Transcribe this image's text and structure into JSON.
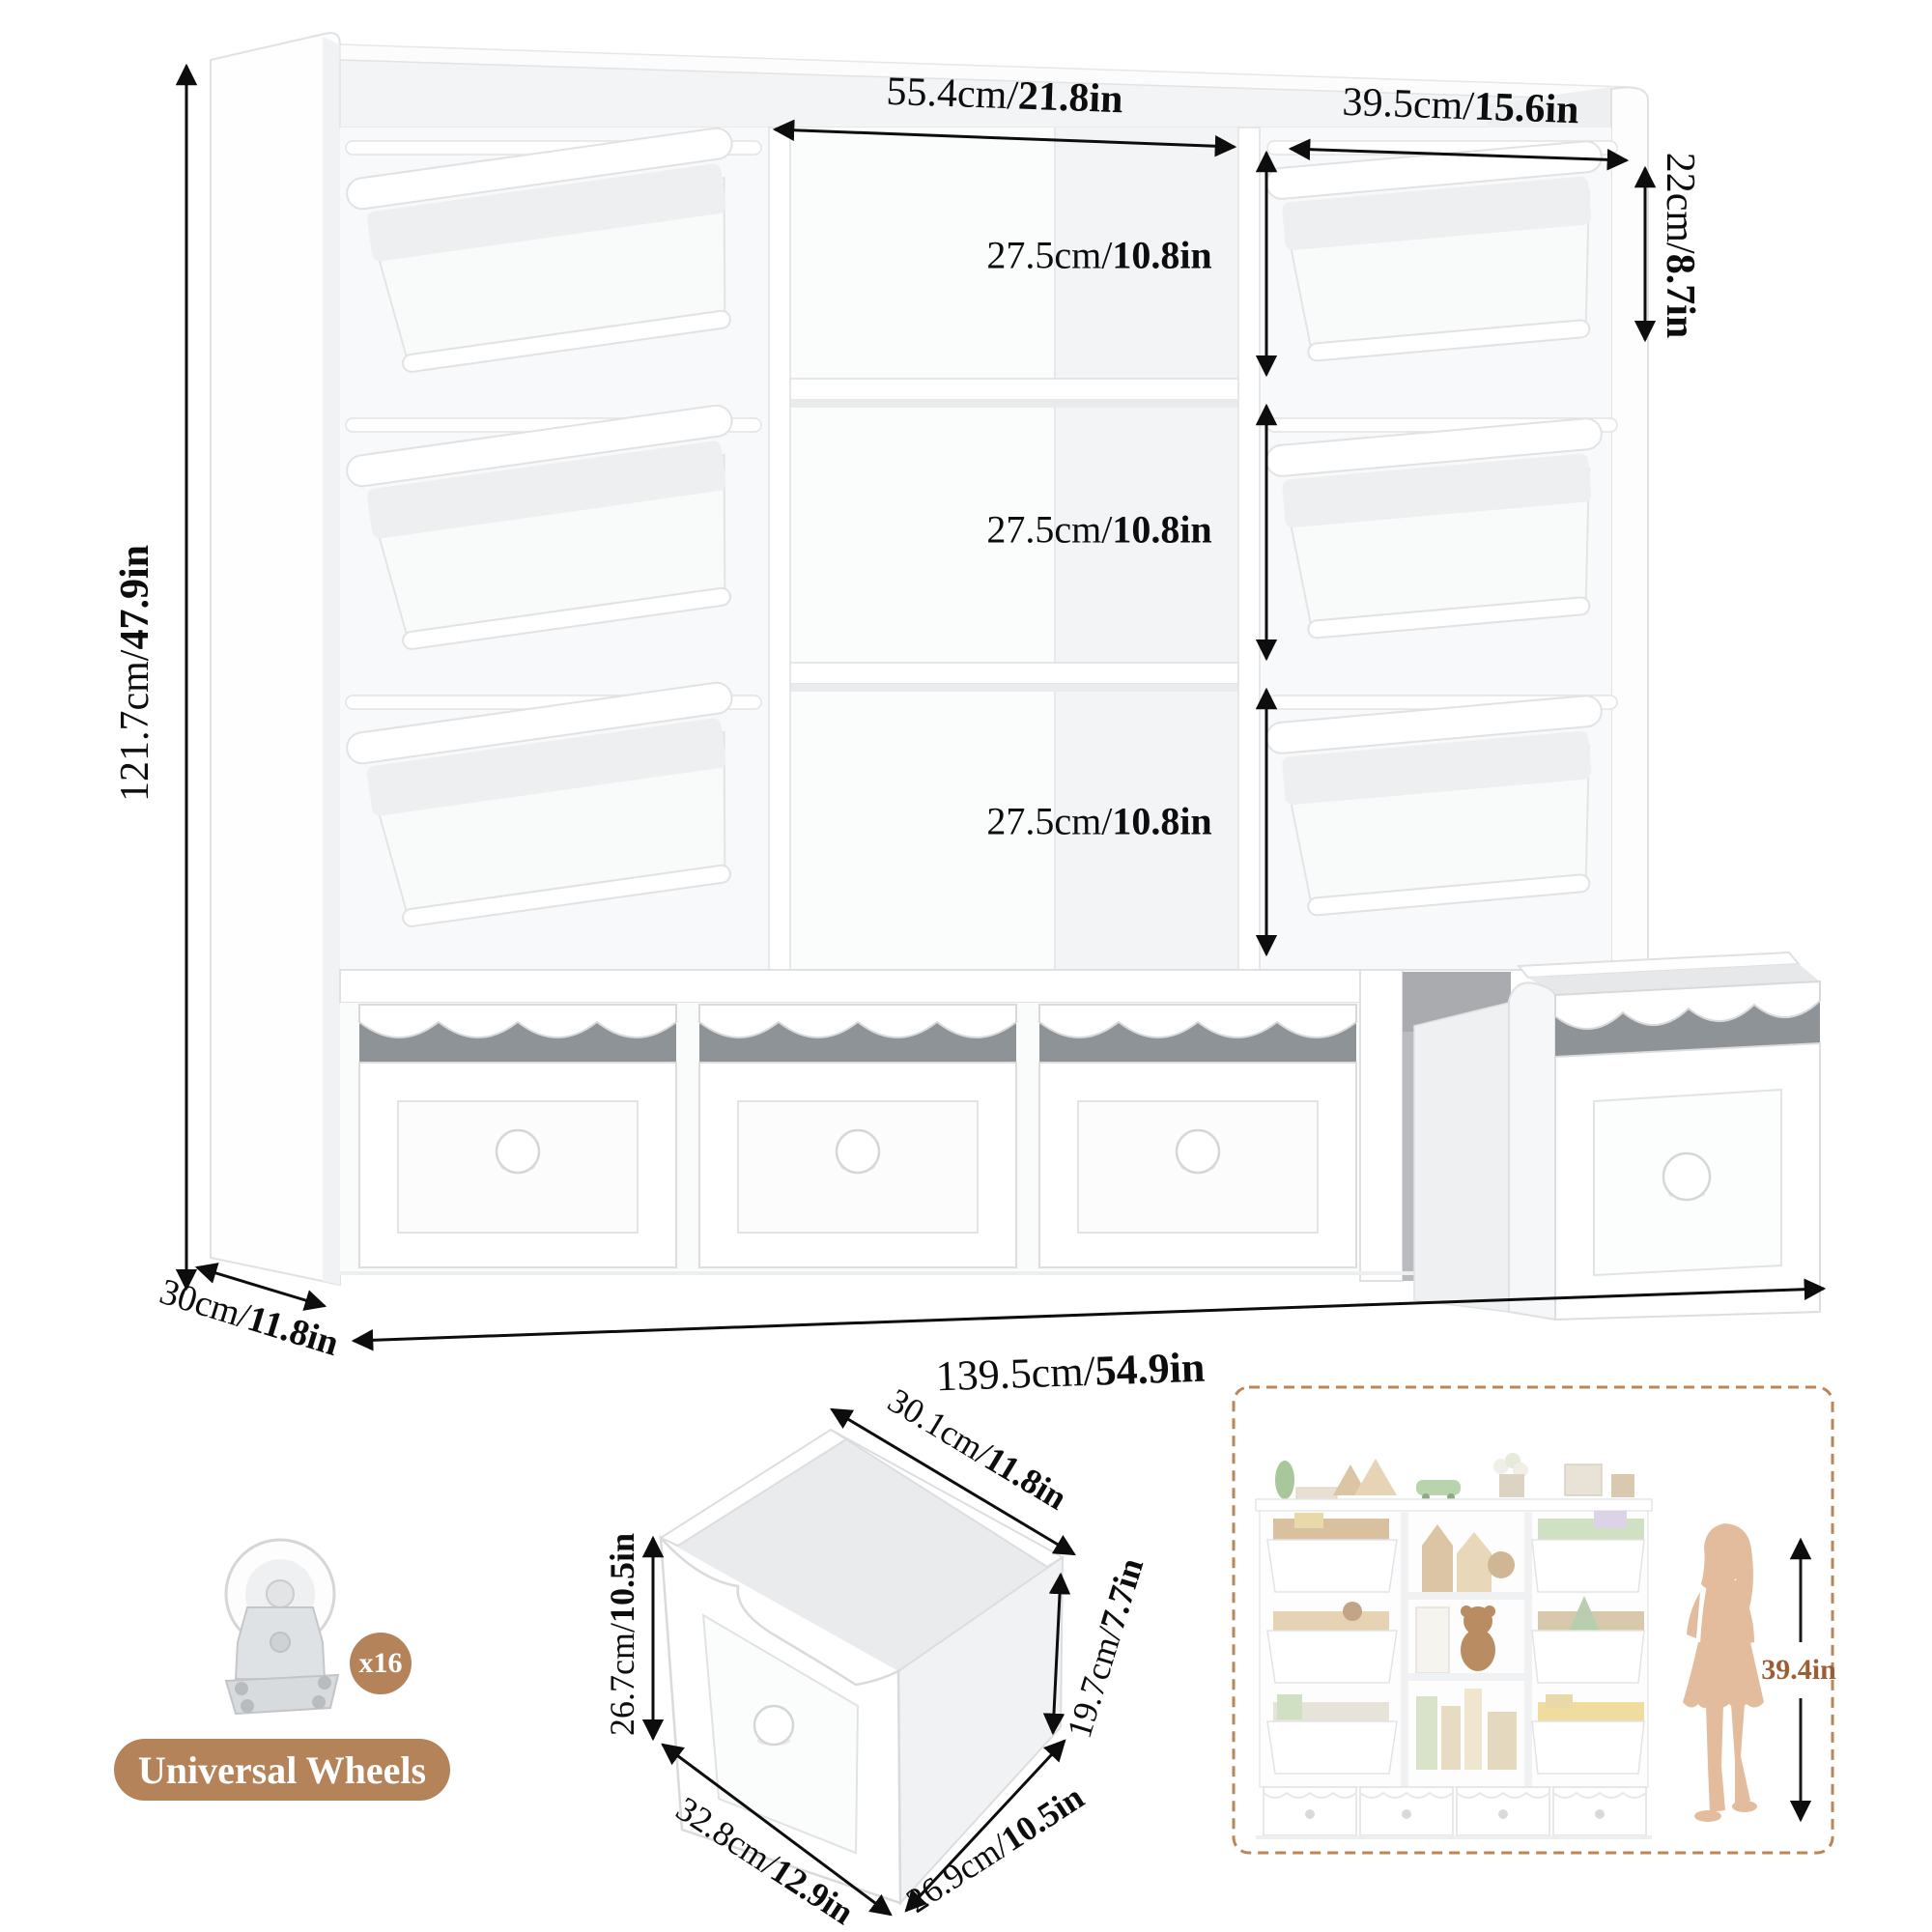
{
  "colors": {
    "accent_tan": "#b5835a",
    "brown_text": "#9c5f35",
    "silhouette": "#e2bc9c",
    "dashed_border": "#bc8556",
    "dim_text": "#0d0d0d"
  },
  "main_diagram": {
    "overall_height": {
      "metric": "121.7cm/",
      "imperial": "47.9in"
    },
    "top_middle_width": {
      "metric": "55.4cm/",
      "imperial": "21.8in"
    },
    "top_right_width": {
      "metric": "39.5cm/",
      "imperial": "15.6in"
    },
    "top_bin_section_height": {
      "metric": "22cm/",
      "imperial": "8.7in"
    },
    "shelf_sections": [
      {
        "metric": "27.5cm/",
        "imperial": "10.8in"
      },
      {
        "metric": "27.5cm/",
        "imperial": "10.8in"
      },
      {
        "metric": "27.5cm/",
        "imperial": "10.8in"
      }
    ],
    "depth": {
      "metric": "30cm/",
      "imperial": "11.8in"
    },
    "overall_width": {
      "metric": "139.5cm/",
      "imperial": "54.9in"
    }
  },
  "drawer_diagram": {
    "top_width": {
      "metric": "30.1cm/",
      "imperial": "11.8in"
    },
    "front_height": {
      "metric": "26.7cm/",
      "imperial": "10.5in"
    },
    "front_width": {
      "metric": "32.8cm/",
      "imperial": "12.9in"
    },
    "bottom_depth": {
      "metric": "26.9cm/",
      "imperial": "10.5in"
    },
    "side_height": {
      "metric": "19.7cm/",
      "imperial": "7.7in"
    }
  },
  "wheels": {
    "count_badge": "x16",
    "label": "Universal Wheels"
  },
  "scale_reference": {
    "child_height": "39.4in"
  }
}
